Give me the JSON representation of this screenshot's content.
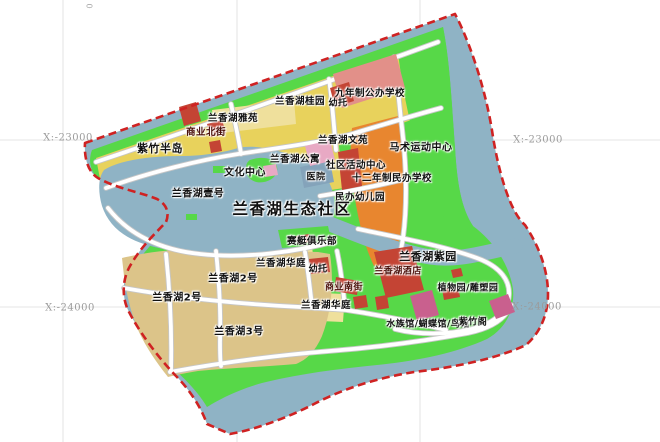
{
  "map": {
    "title": "兰香湖生态社区",
    "coords": {
      "left_top": "X:-23000",
      "right_top": "X:-23000",
      "left_bottom": "X:-24000",
      "right_bottom": "X:-24000",
      "corner_mark": "0"
    },
    "labels": {
      "zizhu_bandao": "紫竹半岛",
      "yihao": "兰香湖壹号",
      "yayuan": "兰香湖雅苑",
      "shangye_beijie": "商业北街",
      "guiyuan": "兰香湖桂园",
      "youtuo_top": "幼托",
      "jiunianzhi": "九年制公办学校",
      "wenyuan": "兰香湖文苑",
      "gongyu": "兰香湖公寓",
      "wenhua_zhongxin": "文化中心",
      "yiyuan": "医院",
      "shequ_huodong": "社区活动中心",
      "mashu": "马术运动中心",
      "shiernian": "十二年制民办学校",
      "minban_youeryuan": "民办幼儿园",
      "saiting_julebu": "赛艇俱乐部",
      "huating_upper": "兰香湖华庭",
      "youtuo_mid": "幼托",
      "erhao_a": "兰香湖2号",
      "erhao_b": "兰香湖2号",
      "sanhao": "兰香湖3号",
      "huating_lower": "兰香湖华庭",
      "shangye_nanjie": "商业南街",
      "jiudian": "兰香湖酒店",
      "ziyuan": "兰香湖紫园",
      "zhiwuyuan": "植物园/雕塑园",
      "shuizuguan": "水族馆/蝴蝶馆/鸟馆",
      "zizhuge": "紫竹阁"
    },
    "palette": {
      "water": "#8fb3c5",
      "green": "#57d848",
      "yellow": "#e8d25c",
      "light_yellow": "#efe09c",
      "tan": "#dcc489",
      "orange": "#e8862f",
      "salmon": "#e29089",
      "red": "#c44434",
      "pink_light": "#e8a9c4",
      "pink_deep": "#c9608e",
      "hospital_blue": "#84a3ba",
      "boundary_red": "#cf2222"
    }
  }
}
